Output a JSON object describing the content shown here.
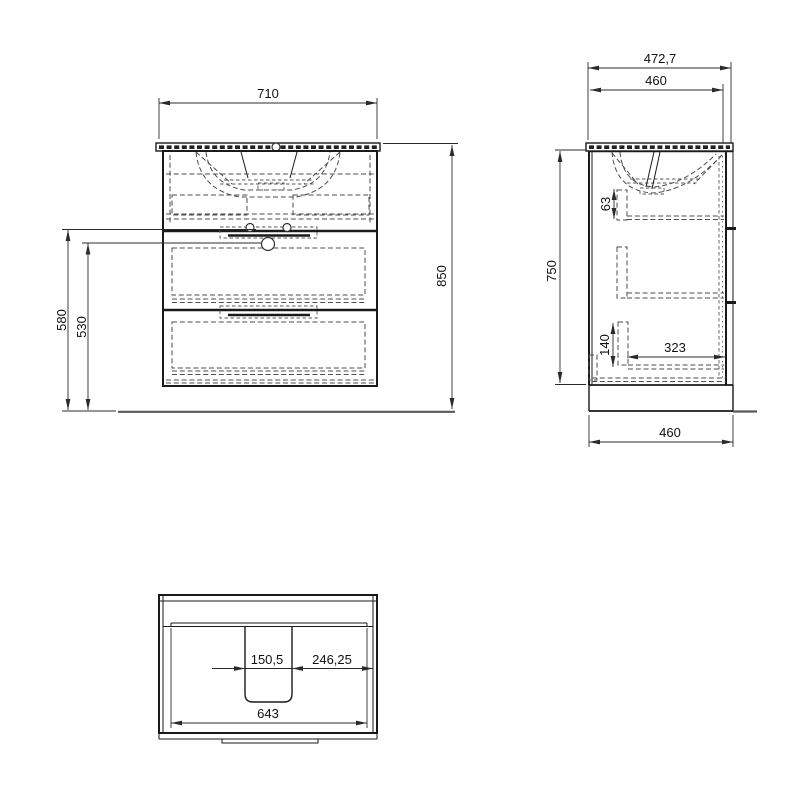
{
  "drawing": {
    "type": "technical-dimension-drawing",
    "subject": "bathroom-vanity-cabinet-with-washbasin",
    "colors": {
      "background": "#ffffff",
      "object_line": "#1a1a1a",
      "hidden_line": "#4d4d4d",
      "dimension_line": "#2b2b2b",
      "floor_line": "#5a5a5a"
    },
    "views": {
      "front": {
        "dims": {
          "width": "710",
          "height_total": "850",
          "h580": "580",
          "h530": "530"
        }
      },
      "side": {
        "dims": {
          "depth_total": "472,7",
          "depth_cabinet": "460",
          "height": "750",
          "d63": "63",
          "d140": "140",
          "d323": "323",
          "depth_bottom": "460"
        }
      },
      "bottom": {
        "dims": {
          "d150": "150,5",
          "d246": "246,25",
          "d643": "643"
        }
      }
    }
  }
}
